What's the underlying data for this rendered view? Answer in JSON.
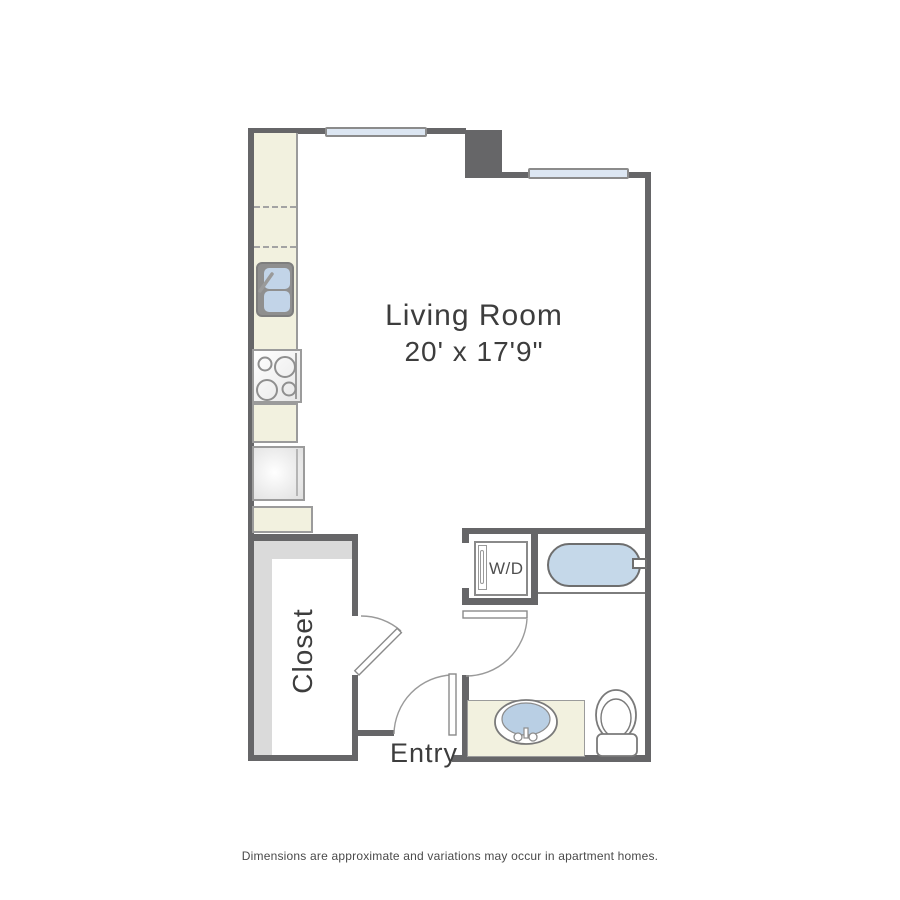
{
  "floorplan": {
    "rooms": {
      "living_room": {
        "label": "Living Room",
        "dimensions": "20' x 17'9\""
      },
      "closet": {
        "label": "Closet"
      },
      "entry": {
        "label": "Entry"
      }
    },
    "appliances": {
      "washer_dryer": {
        "label": "W/D"
      }
    },
    "fixtures": [
      "kitchen-counter",
      "kitchen-sink",
      "stove",
      "refrigerator",
      "bathtub",
      "toilet",
      "bathroom-sink",
      "vanity",
      "window",
      "window",
      "closet-shelving",
      "door",
      "door",
      "door"
    ],
    "colors": {
      "wall": "#666668",
      "counter": "#f2f1df",
      "window": "#dce6f2",
      "tub": "#c5d8e9",
      "sink_basin": "#bcd1e6",
      "closet_shelf": "#dadada",
      "text": "#3d3d3d"
    }
  },
  "footer": {
    "disclaimer": "Dimensions are approximate and variations may occur in apartment homes."
  }
}
